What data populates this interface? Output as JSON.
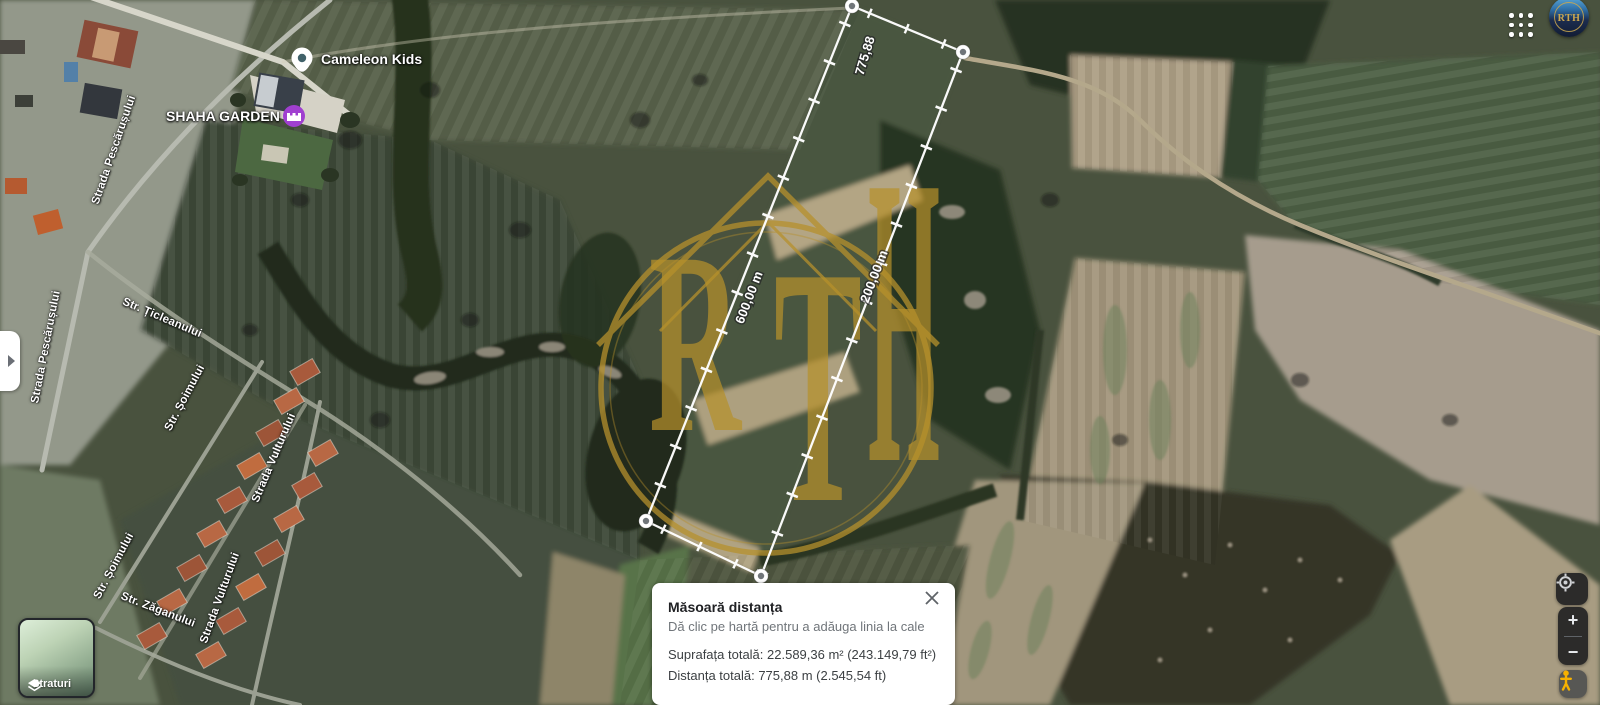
{
  "places": [
    {
      "name": "Cameleon Kids"
    },
    {
      "name": "SHAHA GARDEN"
    }
  ],
  "streets": [
    {
      "name": "Strada Pescărușului"
    },
    {
      "name": "Str. Țicleanului"
    },
    {
      "name": "Strada Pescărușului"
    },
    {
      "name": "Str. Șoimului"
    },
    {
      "name": "Strada Vulturului"
    },
    {
      "name": "Str. Șoimului"
    },
    {
      "name": "Str. Zăganului"
    },
    {
      "name": "Strada Vulturului"
    }
  ],
  "measurement": {
    "segment_labels": [
      "775,88",
      "600,00 m",
      "200,00 m"
    ],
    "panel": {
      "title": "Măsoară distanța",
      "subtitle": "Dă clic pe hartă pentru a adăuga linia la cale",
      "area": "Suprafața totală: 22.589,36 m² (243.149,79 ft²)",
      "distance": "Distanța totală: 775,88 m (2.545,54 ft)"
    }
  },
  "controls": {
    "layers_label": "Straturi",
    "zoom_in": "+",
    "zoom_out": "−"
  },
  "branding": {
    "letters": "RTH"
  },
  "colors": {
    "watermark_gold": "#b6902c",
    "poi_purple": "#a03fd0",
    "pegman_yellow": "#f6b100",
    "panel_text": "#202124",
    "panel_secondary": "#70757a"
  }
}
